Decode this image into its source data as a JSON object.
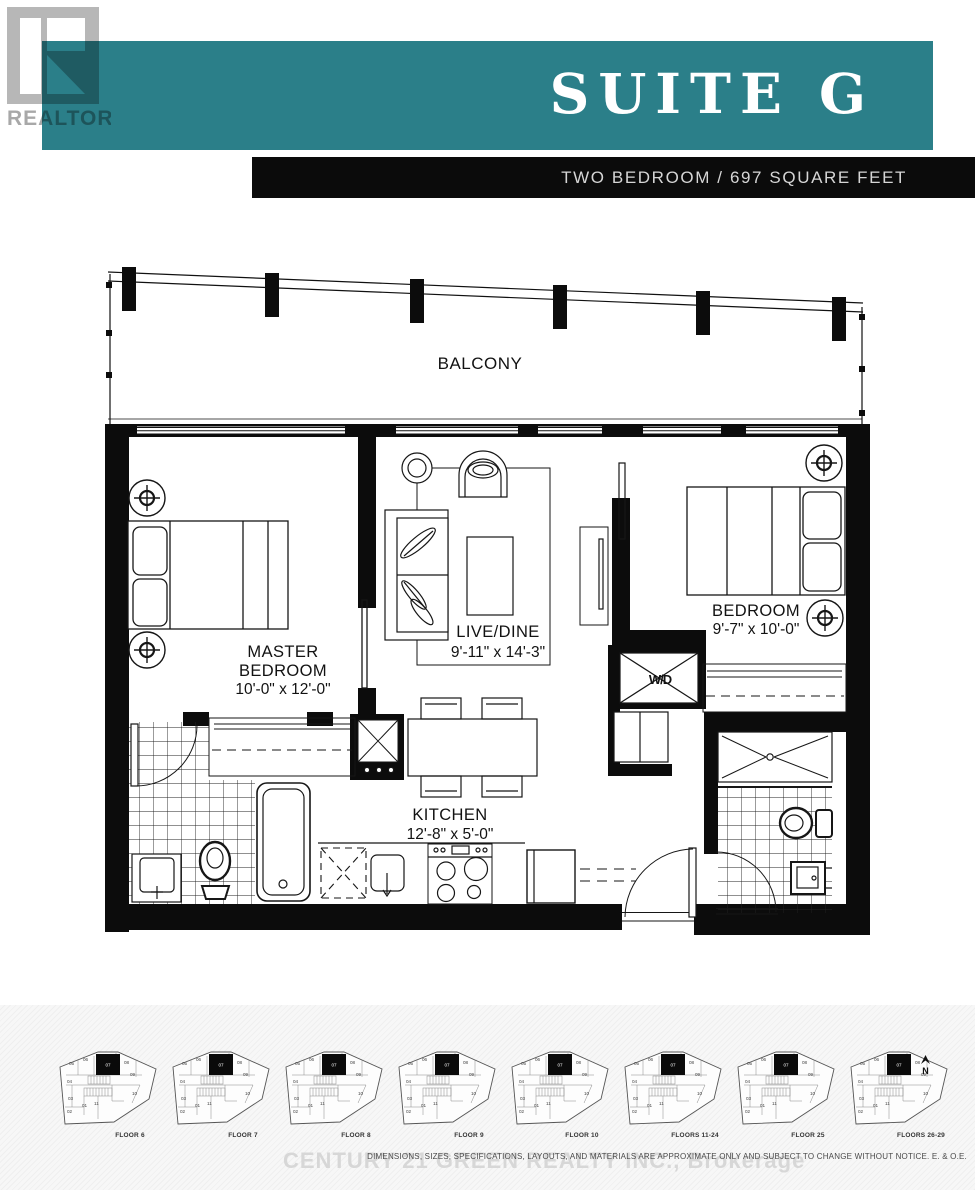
{
  "header": {
    "suite_title": "SUITE G",
    "subtitle": "TWO BEDROOM / 697 SQUARE FEET",
    "teal_color": "#2b7f89",
    "banner_color": "#0b0b0b",
    "logo_text": "REALTOR",
    "logo_registered": "®"
  },
  "floorplan": {
    "balcony_label": "BALCONY",
    "wd_label": "W/D",
    "rooms": {
      "master": {
        "line1": "MASTER",
        "line2": "BEDROOM",
        "dims": "10'-0\" x 12'-0\""
      },
      "living": {
        "name": "LIVE/DINE",
        "dims": "9'-11\" x 14'-3\""
      },
      "bedroom": {
        "name": "BEDROOM",
        "dims": "9'-7\" x 10'-0\""
      },
      "kitchen": {
        "name": "KITCHEN",
        "dims": "12'-8\" x 5'-0\""
      }
    }
  },
  "keyplans": {
    "north_label": "N",
    "highlight_unit": "07",
    "units": [
      "05",
      "06",
      "08",
      "09",
      "10",
      "11",
      "01",
      "02",
      "03",
      "04"
    ],
    "floors": [
      {
        "label": "FLOOR 6"
      },
      {
        "label": "FLOOR 7"
      },
      {
        "label": "FLOOR 8"
      },
      {
        "label": "FLOOR 9"
      },
      {
        "label": "FLOOR 10"
      },
      {
        "label": "FLOORS 11-24"
      },
      {
        "label": "FLOOR 25"
      },
      {
        "label": "FLOORS 26-29"
      }
    ]
  },
  "footer": {
    "watermark": "CENTURY 21 GREEN REALTY INC., Brokerage",
    "disclaimer": "DIMENSIONS, SIZES, SPECIFICATIONS, LAYOUTS, AND MATERIALS ARE APPROXIMATE ONLY AND SUBJECT TO CHANGE WITHOUT NOTICE. E. & O.E."
  }
}
